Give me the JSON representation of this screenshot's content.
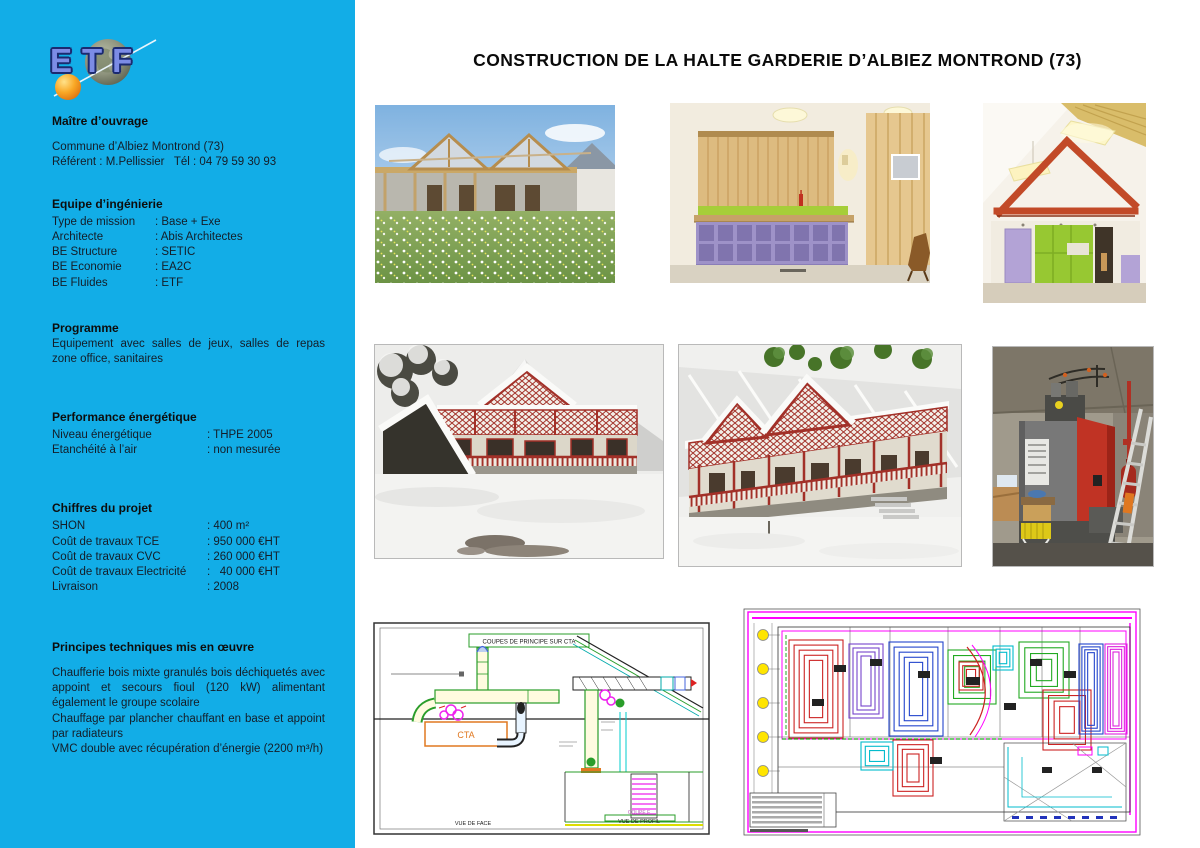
{
  "colors": {
    "sidebar": "#12ADE7",
    "accent_orange": "#F7941D",
    "logo_blue": "#7C8CE6"
  },
  "logo": {
    "text": "ETF"
  },
  "header": {
    "title": "CONSTRUCTION DE LA HALTE GARDERIE D’ALBIEZ MONTROND (73)"
  },
  "sidebar": {
    "maitre_ouvrage": {
      "title": "Maître d’ouvrage",
      "lines": [
        "Commune d’Albiez Montrond (73)",
        "Référent : M.Pellissier   Tél : 04 79 59 30 93"
      ]
    },
    "equipe": {
      "title": "Equipe d’ingénierie",
      "rows": [
        {
          "label": "Type de mission",
          "value": ": Base + Exe"
        },
        {
          "label": "Architecte",
          "value": ": Abis Architectes"
        },
        {
          "label": "BE Structure",
          "value": ": SETIC"
        },
        {
          "label": "BE Economie",
          "value": ": EA2C"
        },
        {
          "label": "BE Fluides",
          "value": ": ETF"
        }
      ]
    },
    "programme": {
      "title": "Programme",
      "text": "Equipement avec salles de jeux, salles de repas zone office, sanitaires"
    },
    "performance": {
      "title": "Performance énergétique",
      "rows": [
        {
          "label": "Niveau énergétique",
          "value": ": THPE 2005"
        },
        {
          "label": "Etanchéité à l’air",
          "value": ": non mesurée"
        }
      ]
    },
    "chiffres": {
      "title": "Chiffres du projet",
      "rows": [
        {
          "label": "SHON",
          "value": ": 400 m²"
        },
        {
          "label": "Coût de travaux TCE",
          "value": ": 950 000 €HT"
        },
        {
          "label": "Coût de travaux CVC",
          "value": ": 260 000 €HT"
        },
        {
          "label": "Coût de travaux Electricité",
          "value": ":   40 000 €HT"
        },
        {
          "label": "Livraison",
          "value": ": 2008"
        }
      ]
    },
    "principes": {
      "title": "Principes techniques mis en œuvre",
      "paragraphs": [
        "Chaufferie bois mixte granulés bois déchiquetés avec appoint et secours fioul (120 kW) alimentant également le groupe scolaire",
        "Chauffage par plancher chauffant en base et appoint par radiateurs",
        "VMC double avec récupération d’énergie  (2200 m³/h)"
      ]
    }
  },
  "drawings": {
    "cta": {
      "title_box": "COUPES DE PRINCIPE SUR CTA",
      "cta_label": "CTA",
      "label_vue_face": "VUE DE FACE",
      "label_coupe_f": "COUPE F",
      "label_vue_profil": "VUE DE PROFIL"
    }
  }
}
